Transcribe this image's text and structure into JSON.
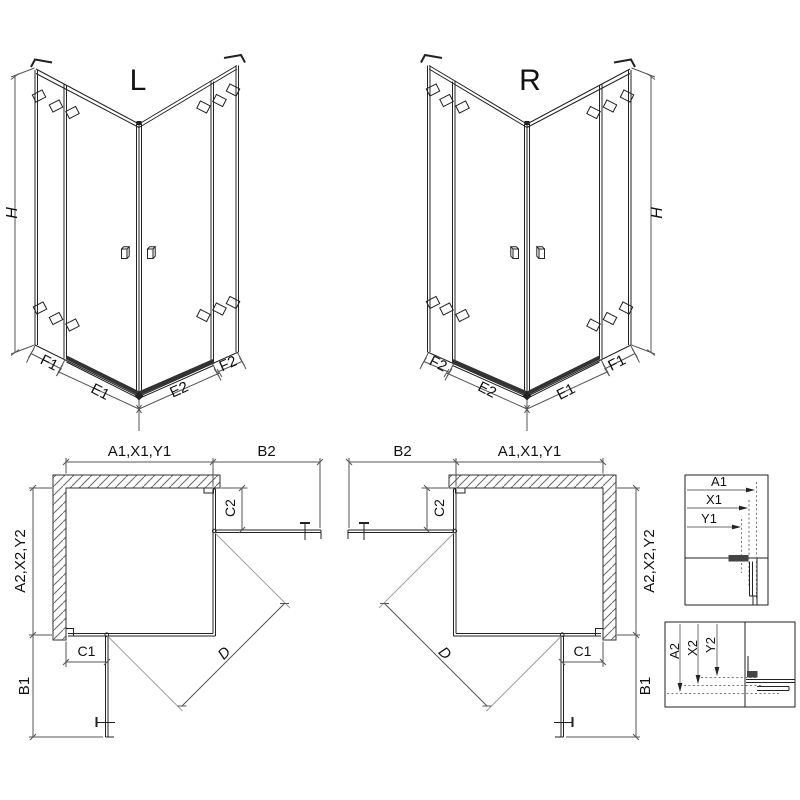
{
  "figures": {
    "front_left": {
      "variant": "L",
      "height": "H",
      "panel_f1": "F1",
      "door_e1": "E1",
      "door_e2": "E2",
      "panel_f2": "F2"
    },
    "front_right": {
      "variant": "R",
      "height": "H",
      "panel_f1": "F1",
      "door_e1": "E1",
      "door_e2": "E2",
      "panel_f2": "F2"
    },
    "plan_left": {
      "width_top": "A1,X1,Y1",
      "return_top": "B2",
      "depth_side": "A2,X2,Y2",
      "return_side": "B1",
      "c1": "C1",
      "c2": "C2",
      "diagonal": "D"
    },
    "plan_right": {
      "width_top": "A1,X1,Y1",
      "return_top": "B2",
      "depth_side": "A2,X2,Y2",
      "return_side": "B1",
      "c1": "C1",
      "c2": "C2",
      "diagonal": "D"
    },
    "detail_width": {
      "a1": "A1",
      "x1": "X1",
      "y1": "Y1"
    },
    "detail_depth": {
      "a2": "A2",
      "x2": "X2",
      "y2": "Y2"
    }
  },
  "colors": {
    "line": "#222222",
    "dim": "#555555",
    "swing": "#999999",
    "hatch": "#666666",
    "background": "#ffffff"
  }
}
